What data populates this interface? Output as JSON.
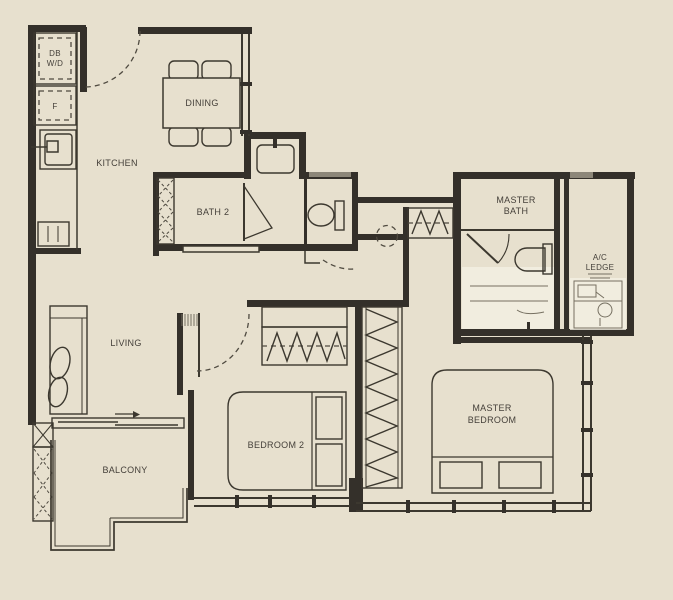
{
  "title": "Residential Unit Floor Plan",
  "palette": {
    "background": "#e7e0ce",
    "wall": "#34302a",
    "line": "#3c382f",
    "light_wash": "#f4f0e3",
    "gray_bar": "#8d8779",
    "text": "#45403a"
  },
  "rooms": {
    "kitchen": {
      "label": "KITCHEN"
    },
    "dining": {
      "label": "DINING"
    },
    "bath2": {
      "label": "BATH 2"
    },
    "master_bath": {
      "line1": "MASTER",
      "line2": "BATH"
    },
    "ac_ledge": {
      "line1": "A/C",
      "line2": "LEDGE"
    },
    "living": {
      "label": "LIVING"
    },
    "balcony": {
      "label": "BALCONY"
    },
    "bedroom2": {
      "label": "BEDROOM 2"
    },
    "master_bedroom": {
      "line1": "MASTER",
      "line2": "BEDROOM"
    }
  },
  "fixtures": {
    "db_wd": {
      "line1": "DB",
      "line2": "W/D"
    },
    "fridge": {
      "label": "F"
    }
  }
}
